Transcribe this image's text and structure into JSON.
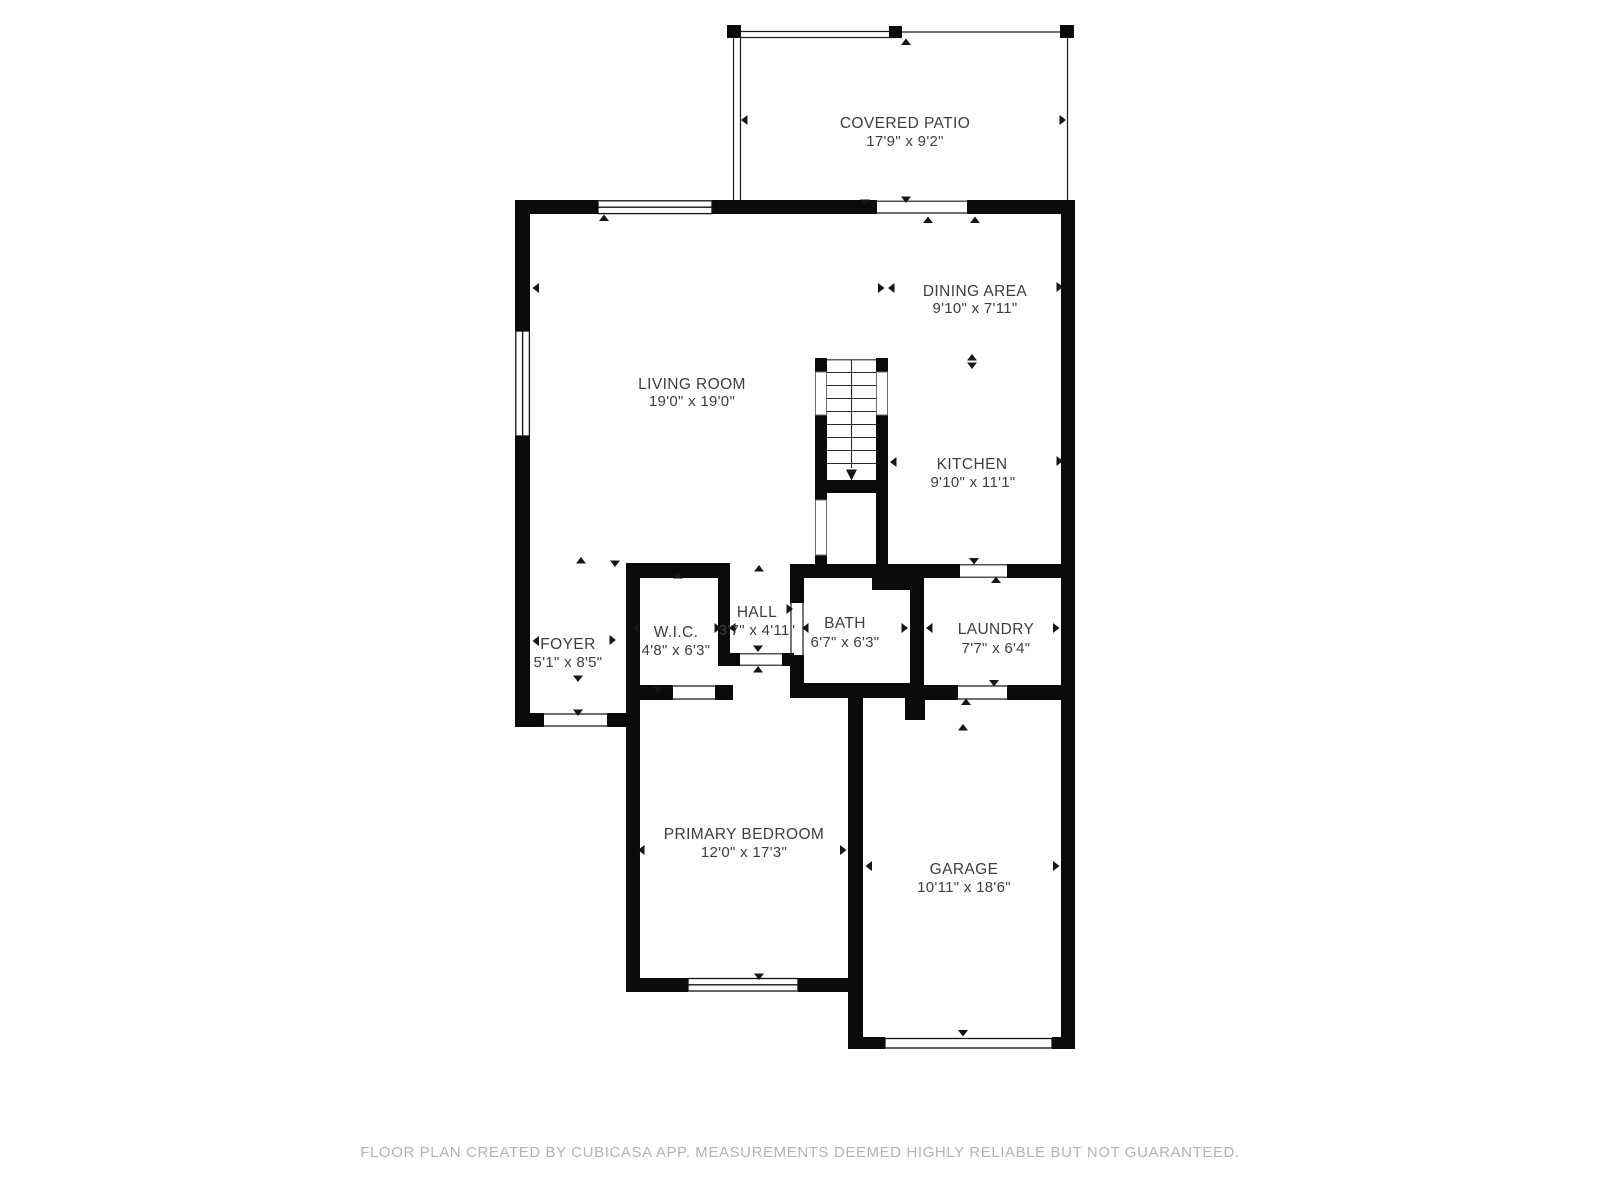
{
  "footer": {
    "text": "FLOOR PLAN CREATED BY CUBICASA APP. MEASUREMENTS DEEMED HIGHLY RELIABLE BUT NOT GUARANTEED."
  },
  "colors": {
    "wall": "#0a0a0a",
    "label_text": "#3d3d3d",
    "footer_text": "#b3b3b3",
    "background": "#ffffff"
  },
  "rooms": [
    {
      "id": "covered-patio",
      "name": "COVERED PATIO",
      "dims": "17'9\" x 9'2\""
    },
    {
      "id": "dining-area",
      "name": "DINING AREA",
      "dims": "9'10\" x 7'11\""
    },
    {
      "id": "living-room",
      "name": "LIVING ROOM",
      "dims": "19'0\" x 19'0\""
    },
    {
      "id": "kitchen",
      "name": "KITCHEN",
      "dims": "9'10\" x 11'1\""
    },
    {
      "id": "foyer",
      "name": "FOYER",
      "dims": "5'1\" x 8'5\""
    },
    {
      "id": "wic",
      "name": "W.I.C.",
      "dims": "4'8\" x 6'3\""
    },
    {
      "id": "hall",
      "name": "HALL",
      "dims": "3'7\" x 4'11\""
    },
    {
      "id": "bath",
      "name": "BATH",
      "dims": "6'7\" x 6'3\""
    },
    {
      "id": "laundry",
      "name": "LAUNDRY",
      "dims": "7'7\" x 6'4\""
    },
    {
      "id": "primary-bedroom",
      "name": "PRIMARY BEDROOM",
      "dims": "12'0\" x 17'3\""
    },
    {
      "id": "garage",
      "name": "GARAGE",
      "dims": "10'11\" x 18'6\""
    }
  ]
}
